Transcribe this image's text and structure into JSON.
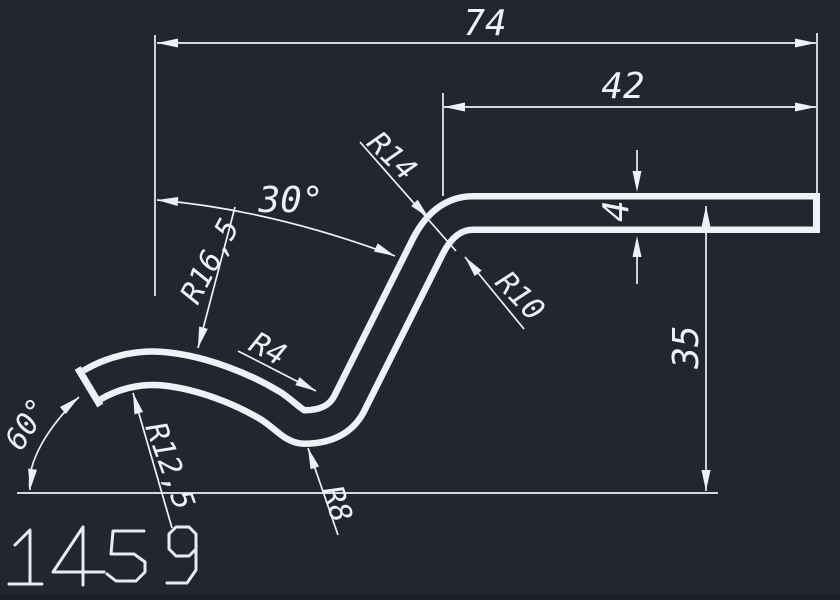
{
  "canvas": {
    "background": "#212631",
    "line_color": "#eef1f5",
    "bottom_edge_color": "#1a1f28"
  },
  "part_number": "1459",
  "dims": {
    "total_width": "74",
    "upper_width": "42",
    "wall_thickness": "4",
    "height": "35",
    "bend_angle": "30°",
    "end_angle": "60°"
  },
  "radii": {
    "top_bend_outer": "R14",
    "top_bend_inner": "R10",
    "crest_outer": "R16,5",
    "crest_inner": "R12,5",
    "valley_inner": "R4",
    "valley_outer": "R8"
  }
}
